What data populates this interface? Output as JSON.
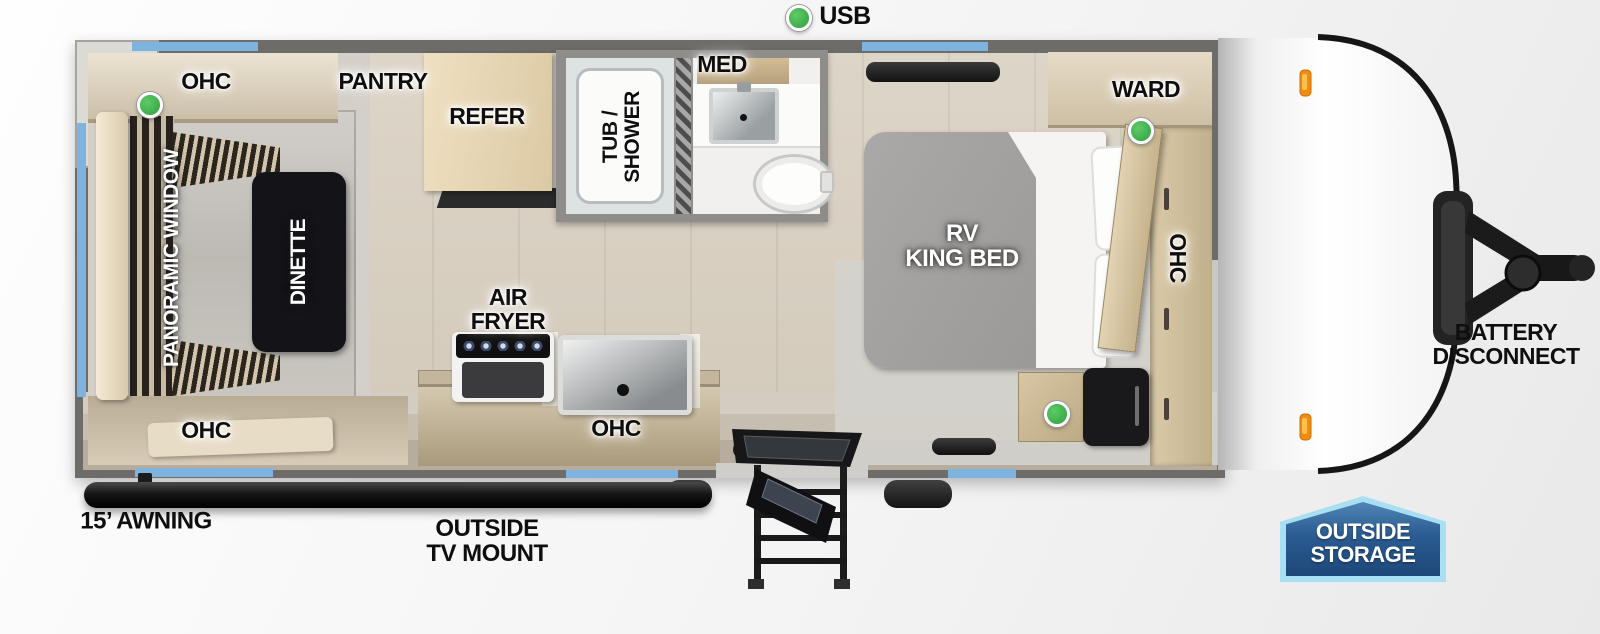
{
  "legend": {
    "usb": "USB"
  },
  "living": {
    "ohc_top": "OHC",
    "ohc_bottom": "OHC",
    "panoramic_window": "PANORAMIC WINDOW",
    "dinette": "DINETTE",
    "pantry": "PANTRY"
  },
  "kitchen": {
    "refer": "REFER",
    "air_fryer": "AIR\nFRYER",
    "ohc": "OHC"
  },
  "bath": {
    "tub_shower": "TUB /\nSHOWER",
    "med": "MED"
  },
  "bedroom": {
    "ward": "WARD",
    "bed": "RV\nKING BED",
    "ohc": "OHC"
  },
  "exterior": {
    "awning": "15’ AWNING",
    "outside_tv_mount": "OUTSIDE\nTV MOUNT",
    "battery_disconnect": "BATTERY\nDISCONNECT",
    "outside_storage": "OUTSIDE\nSTORAGE"
  },
  "colors": {
    "window_blue": "#7db3de",
    "indicator_green": "#3cb24a",
    "wall_gray": "#6e6c69",
    "badge_border": "#a9dff2",
    "badge_fill_top": "#4f86b4",
    "badge_fill_bottom": "#1d4878",
    "marker_orange": "#ef8d12"
  }
}
